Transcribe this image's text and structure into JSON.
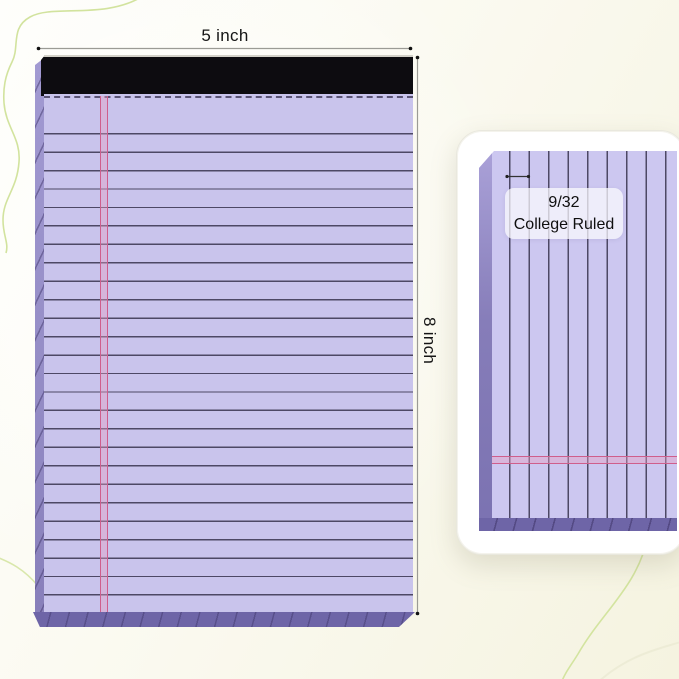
{
  "annotations": {
    "width_label": "5 inch",
    "height_label": "8 inch"
  },
  "ruling_badge": {
    "line1": "9/32",
    "line2": "College Ruled"
  },
  "colors": {
    "paper_lavender": "#c9c4ec",
    "rule_line": "#4d4865",
    "margin_line_pink": "#cf5e8c",
    "binding_black": "#0d0c10",
    "pad_edge_purple": "#6e65a7",
    "squiggle_green": "#cde093",
    "card_white": "#ffffff",
    "background_cream": "#f5f3e0"
  }
}
